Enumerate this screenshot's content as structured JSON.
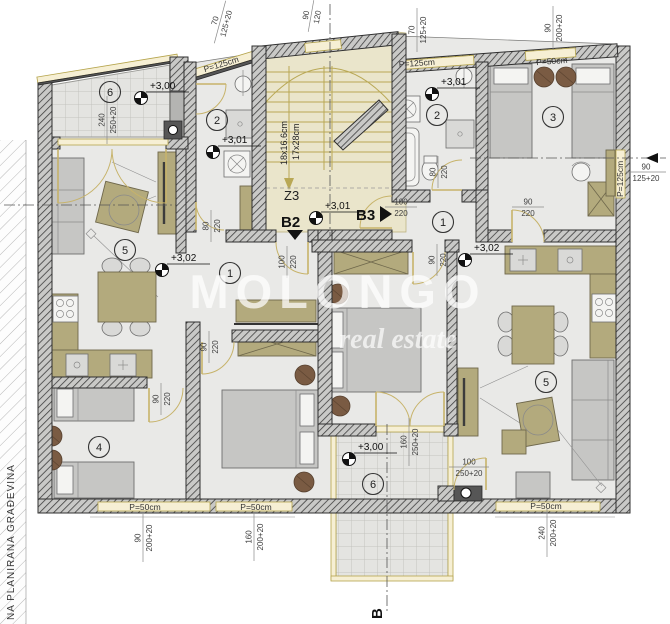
{
  "watermark": {
    "brand": "MOLONGO",
    "tagline": "real estate"
  },
  "site_label": "NA PLANIRANA GRAĐEVINA",
  "stairwell": {
    "flight_label": "Z3",
    "tread_note_line1": "18x16.6cm",
    "tread_note_line2": "17x28cm"
  },
  "section_markers": {
    "b2": "B2",
    "b3": "B3",
    "b_bottom": "B"
  },
  "levels": {
    "terrace_top_left": "+3,00",
    "bath_left": "+3,01",
    "stair_landing": "+3,01",
    "bath_right": "+3,01",
    "hall_left": "+3,02",
    "hall_right": "+3,02",
    "terrace_bottom": "+3,00"
  },
  "room_numbers": {
    "terrace_top_left": "6",
    "bath_left": "2",
    "living_left": "5",
    "hall_left": "1",
    "bedroom_left": "4",
    "bath_right": "2",
    "bedroom_right": "3",
    "hall_right": "1",
    "living_right": "5",
    "terrace_bottom": "6"
  },
  "parapets": {
    "top_left_slant": "P=125cm",
    "top_bath_right": "P=125cm",
    "top_bedroom3": "P=50cm",
    "right_edge": "P=125cm",
    "bottom_left": "P=50cm",
    "bottom_center": "P=50cm",
    "bottom_right": "P=50cm"
  },
  "dimensions": {
    "terrace_tl": {
      "a": "240",
      "b": "250+20"
    },
    "top_left_window": {
      "a": "70",
      "b": "125+20"
    },
    "stair_top_window": {
      "a": "90",
      "b": "120"
    },
    "bath_right_window": {
      "a": "70",
      "b": "125+20"
    },
    "bedroom3_window": {
      "a": "90",
      "b": "200+20"
    },
    "right_edge_window": {
      "a": "90",
      "b": "125+20"
    },
    "bottom_room4_window": {
      "a": "90",
      "b": "200+20"
    },
    "bottom_bedroom_window": {
      "a": "160",
      "b": "200+20"
    },
    "bottom_living_right_window": {
      "a": "240",
      "b": "200+20"
    },
    "terrace_bottom_door": {
      "a": "160",
      "b": "250+20"
    },
    "living_right_terrace_door": {
      "a": "100",
      "b": "250+20"
    },
    "bath_left_door": {
      "a": "80",
      "b": "220"
    },
    "entry_left_door": {
      "a": "100",
      "b": "220"
    },
    "bedroom_left_door": {
      "a": "90",
      "b": "220"
    },
    "room4_door": {
      "a": "90",
      "b": "220"
    },
    "bath_right_door": {
      "a": "80",
      "b": "220"
    },
    "entry_right_door": {
      "a": "100",
      "b": "220"
    },
    "bedroom3_door": {
      "a": "90",
      "b": "220"
    },
    "bedroom_right_door": {
      "a": "90",
      "b": "220"
    }
  }
}
